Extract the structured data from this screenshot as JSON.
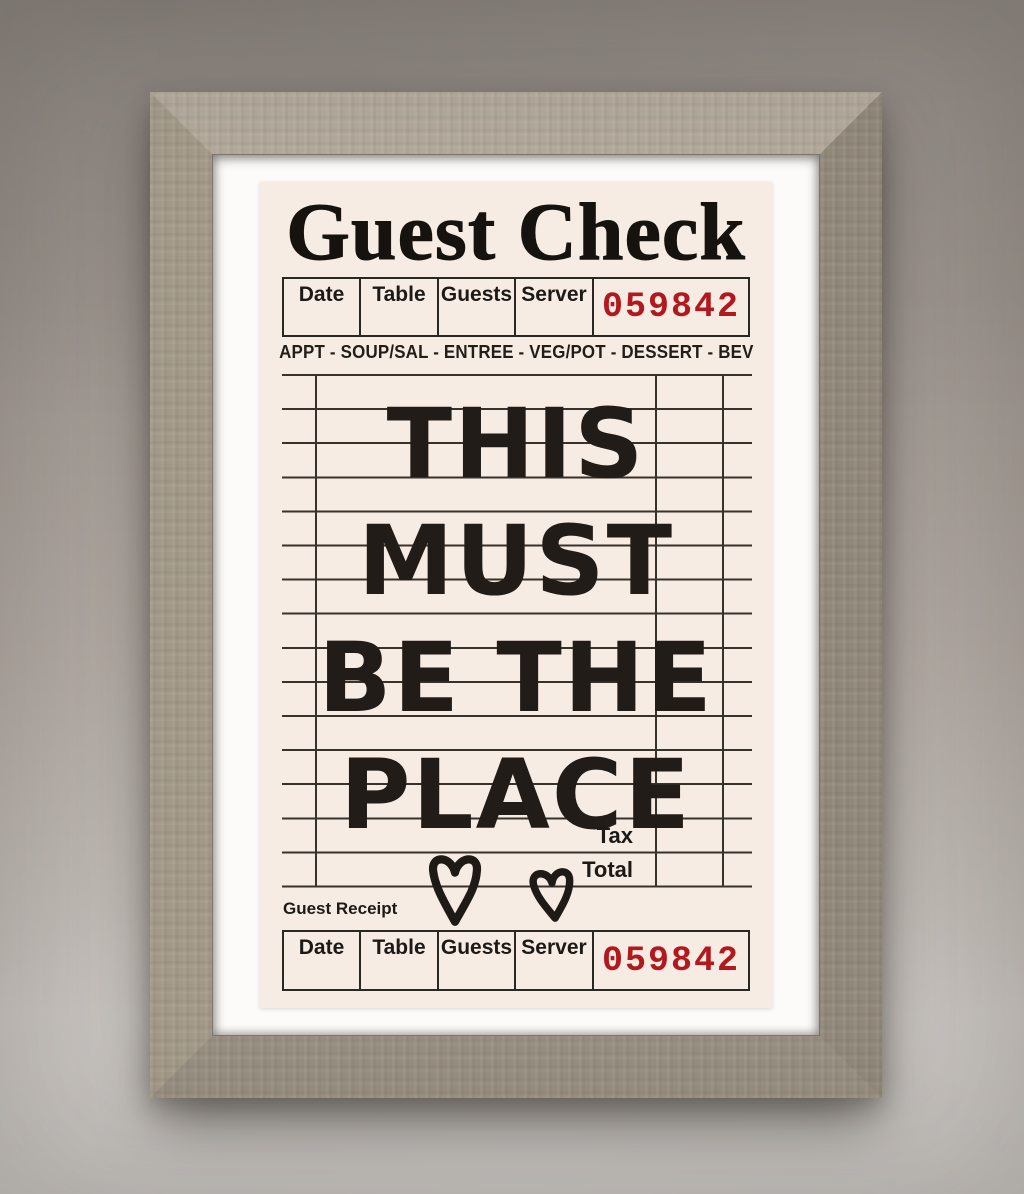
{
  "artwork": {
    "title": "Guest Check",
    "check_number": "059842",
    "columns": [
      "Date",
      "Table",
      "Guests",
      "Server"
    ],
    "menu_line": "APPT - SOUP/SAL - ENTREE - VEG/POT - DESSERT - BEV",
    "message_lines": [
      "THIS",
      "MUST",
      "BE THE",
      "PLACE"
    ],
    "tax_label": "Tax",
    "total_label": "Total",
    "receipt": {
      "label": "Guest Receipt",
      "number": "059842"
    },
    "icons": {
      "hearts": "heart-icon"
    },
    "colors": {
      "paper": "#f7ece3",
      "ink": "#1c1916",
      "number_red": "#b2191e",
      "frame_wood": "#a29988",
      "mat_white": "#fcfbf9",
      "wall_top": "#958e88",
      "wall_bottom": "#c7c2be"
    }
  }
}
